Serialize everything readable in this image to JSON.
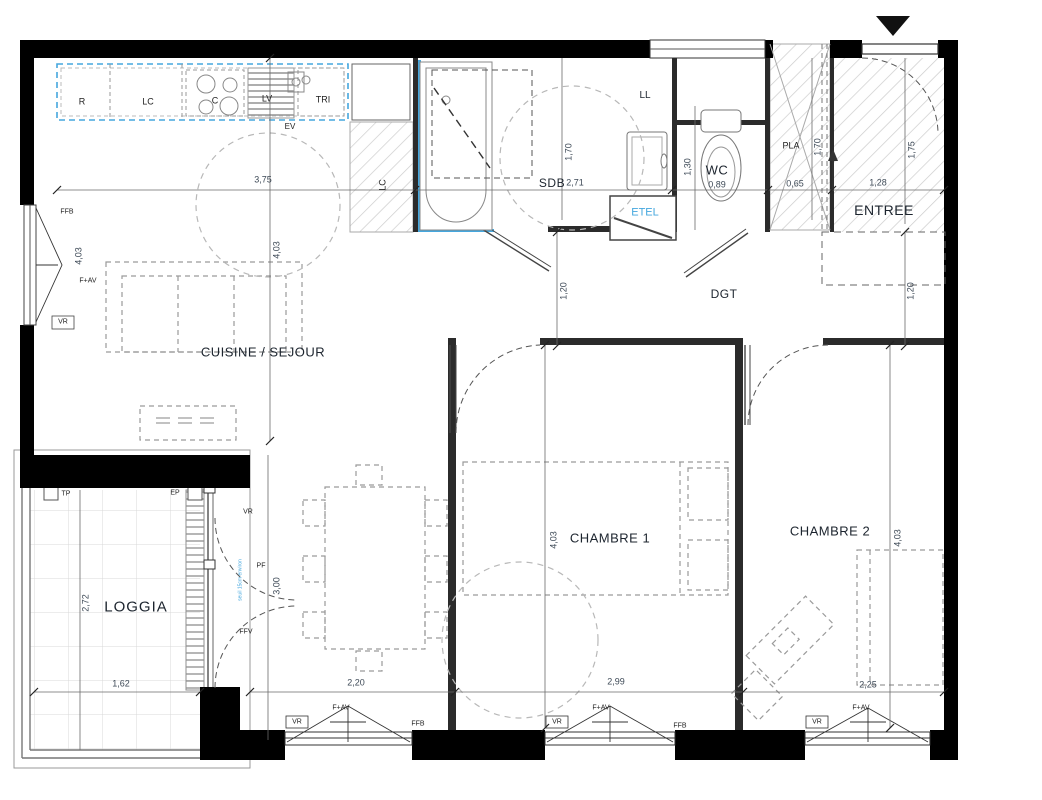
{
  "rooms": {
    "cuisine_sejour": "CUISINE / SEJOUR",
    "sdb": "SDB",
    "wc": "WC",
    "pla": "PLA",
    "entree": "ENTREE",
    "dgt": "DGT",
    "etel": "ETEL",
    "chambre1": "CHAMBRE 1",
    "chambre2": "CHAMBRE 2",
    "loggia": "LOGGIA"
  },
  "appliances": {
    "refrigerator": "R",
    "lc": "LC",
    "cooktop": "C",
    "dishwasher": "LV",
    "tri": "TRI",
    "sink": "EV",
    "washing_machine": "LL",
    "lc_column": "LC"
  },
  "openings": {
    "ffb": "FFB",
    "f_av": "F+AV",
    "vr": "VR",
    "pf": "PF",
    "ffv": "FFV",
    "tp": "TP",
    "ep": "EP"
  },
  "dimensions": {
    "kitchen_width": "3,75",
    "sejour_height": "4,03",
    "sdb_width": "2,71",
    "sdb_height": "1,70",
    "wc_height": "1,30",
    "wc_width": "0,89",
    "pla_width": "0,65",
    "pla_height": "1,70",
    "entree_width": "1,28",
    "entree_height": "1,75",
    "dgt_depth": "1,20",
    "chambre1_height": "4,03",
    "chambre2_height": "4,03",
    "sejour_window_width": "2,20",
    "chambre1_width": "2,99",
    "chambre2_width": "2,25",
    "loggia_width": "1,62",
    "loggia_depth": "2,72",
    "pf_height": "3,00"
  },
  "annotations": {
    "seuil_note": "seuil 15cm environ"
  },
  "colors": {
    "wall": "#000000",
    "accent_blue": "#45A7DE",
    "dim_text": "#3E4A57"
  }
}
